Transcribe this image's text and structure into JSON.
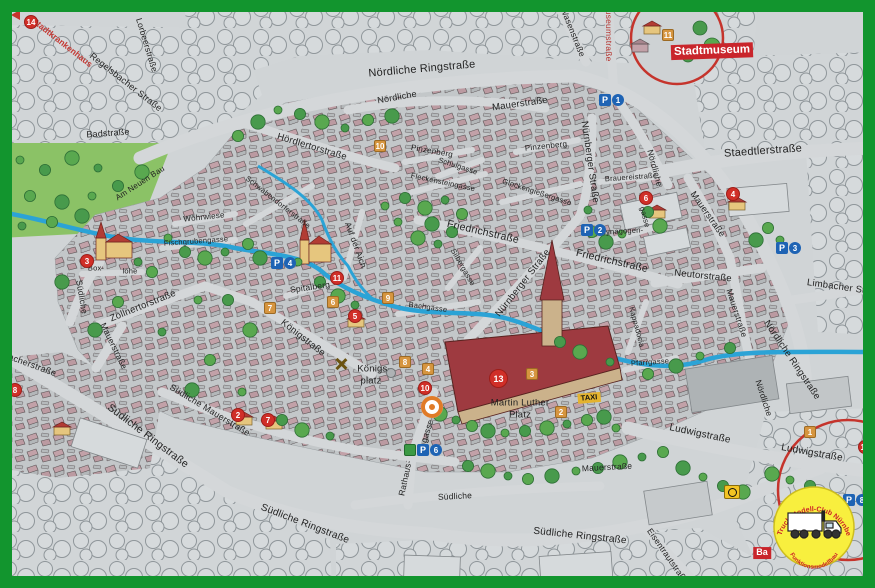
{
  "map": {
    "street_labels": [
      {
        "text": "Lorbeerstraße",
        "x": 147,
        "y": 45,
        "rot": 73,
        "size": 8.5
      },
      {
        "text": "Regelsbacher Straße",
        "x": 126,
        "y": 82,
        "rot": 38,
        "size": 9
      },
      {
        "text": "Badstraße",
        "x": 108,
        "y": 133,
        "rot": -4,
        "size": 9
      },
      {
        "text": "Am Neuen Bau",
        "x": 140,
        "y": 183,
        "rot": -33,
        "size": 8
      },
      {
        "text": "Wöhrwiese",
        "x": 204,
        "y": 217,
        "rot": -6,
        "size": 8
      },
      {
        "text": "Fischgrubengasse",
        "x": 196,
        "y": 241,
        "rot": -4,
        "size": 7.5
      },
      {
        "text": "Hördlertorstraße",
        "x": 312,
        "y": 147,
        "rot": 17,
        "size": 9.5
      },
      {
        "text": "Nördliche Ringstraße",
        "x": 422,
        "y": 69,
        "rot": -5,
        "size": 11
      },
      {
        "text": "Nördliche",
        "x": 397,
        "y": 97,
        "rot": -10,
        "size": 9
      },
      {
        "text": "Mauerstraße",
        "x": 520,
        "y": 104,
        "rot": -8,
        "size": 9.5
      },
      {
        "text": "Pinzenberg",
        "x": 432,
        "y": 151,
        "rot": 10,
        "size": 8
      },
      {
        "text": "Pinzenberg",
        "x": 546,
        "y": 146,
        "rot": -6,
        "size": 8
      },
      {
        "text": "Schulgasse",
        "x": 458,
        "y": 166,
        "rot": 18,
        "size": 7.5
      },
      {
        "text": "Fleckensteingasse",
        "x": 443,
        "y": 182,
        "rot": 12,
        "size": 7.5
      },
      {
        "text": "Glockengießergasse",
        "x": 537,
        "y": 192,
        "rot": 18,
        "size": 7.5
      },
      {
        "text": "Schwabendorferstraße",
        "x": 278,
        "y": 202,
        "rot": 38,
        "size": 7.5
      },
      {
        "text": "Auf der Aich",
        "x": 356,
        "y": 245,
        "rot": 70,
        "size": 8.5
      },
      {
        "text": "Wasenstraße",
        "x": 573,
        "y": 32,
        "rot": 68,
        "size": 8.5
      },
      {
        "text": "Museumstraße",
        "x": 609,
        "y": 32,
        "rot": 90,
        "size": 8.5,
        "color": "#b5342f"
      },
      {
        "text": "Staedtlerstraße",
        "x": 763,
        "y": 151,
        "rot": -4,
        "size": 11
      },
      {
        "text": "Nördliche",
        "x": 655,
        "y": 168,
        "rot": 75,
        "size": 8.5
      },
      {
        "text": "Brauereistraße",
        "x": 631,
        "y": 177,
        "rot": -4,
        "size": 7.5
      },
      {
        "text": "Mauerstraße",
        "x": 708,
        "y": 214,
        "rot": 55,
        "size": 9
      },
      {
        "text": "Nürnberger Straße",
        "x": 590,
        "y": 162,
        "rot": 82,
        "size": 9.5
      },
      {
        "text": "Friedrichstraße",
        "x": 483,
        "y": 232,
        "rot": 13,
        "size": 10.5
      },
      {
        "text": "Friedrichstraße",
        "x": 612,
        "y": 261,
        "rot": 13,
        "size": 10.5
      },
      {
        "text": "Nürnberger Straße",
        "x": 523,
        "y": 283,
        "rot": -52,
        "size": 9.5
      },
      {
        "text": "Silbergasse",
        "x": 463,
        "y": 267,
        "rot": 60,
        "size": 7.5
      },
      {
        "text": "Bachgasse",
        "x": 428,
        "y": 307,
        "rot": 8,
        "size": 7.5
      },
      {
        "text": "Synagogen-",
        "x": 622,
        "y": 231,
        "rot": -3,
        "size": 7.5
      },
      {
        "text": "gasse",
        "x": 645,
        "y": 217,
        "rot": 75,
        "size": 7.5
      },
      {
        "text": "Neutorstraße",
        "x": 703,
        "y": 276,
        "rot": 6,
        "size": 9.5
      },
      {
        "text": "Limbacher Straße",
        "x": 846,
        "y": 288,
        "rot": 8,
        "size": 9.5
      },
      {
        "text": "Kappadocia",
        "x": 637,
        "y": 327,
        "rot": 75,
        "size": 7.5
      },
      {
        "text": "Pfarrgasse",
        "x": 650,
        "y": 362,
        "rot": -4,
        "size": 7.5
      },
      {
        "text": "Mauerstraße",
        "x": 737,
        "y": 313,
        "rot": 72,
        "size": 8.5
      },
      {
        "text": "Nördliche Ringstraße",
        "x": 792,
        "y": 360,
        "rot": 56,
        "size": 9.5
      },
      {
        "text": "Zöllnertorstraße",
        "x": 143,
        "y": 306,
        "rot": -22,
        "size": 9.5
      },
      {
        "text": "Mauerstraße",
        "x": 114,
        "y": 346,
        "rot": 64,
        "size": 8.5
      },
      {
        "text": "Südliche",
        "x": 82,
        "y": 297,
        "rot": 80,
        "size": 8.5
      },
      {
        "text": "Königstraße",
        "x": 303,
        "y": 338,
        "rot": 38,
        "size": 9.5
      },
      {
        "text": "Spitalberg",
        "x": 310,
        "y": 287,
        "rot": -8,
        "size": 8.5
      },
      {
        "text": "Box-",
        "x": 96,
        "y": 268,
        "rot": 0,
        "size": 7.5
      },
      {
        "text": "lohe",
        "x": 130,
        "y": 271,
        "rot": 0,
        "size": 7.5
      },
      {
        "text": "Königs-",
        "x": 374,
        "y": 369,
        "rot": 0,
        "size": 9.5
      },
      {
        "text": "platz",
        "x": 371,
        "y": 381,
        "rot": 0,
        "size": 9.5
      },
      {
        "text": "Martin Luther",
        "x": 520,
        "y": 403,
        "rot": 0,
        "size": 9.5
      },
      {
        "text": "Platz",
        "x": 520,
        "y": 415,
        "rot": 0,
        "size": 9.5
      },
      {
        "text": "Südliche Mauerstraße",
        "x": 210,
        "y": 410,
        "rot": 31,
        "size": 9
      },
      {
        "text": "Südliche Ringstraße",
        "x": 148,
        "y": 436,
        "rot": 37,
        "size": 10.5
      },
      {
        "text": "Südliche Ringstraße",
        "x": 305,
        "y": 524,
        "rot": 21,
        "size": 10
      },
      {
        "text": "Südliche",
        "x": 455,
        "y": 496,
        "rot": -3,
        "size": 8.5
      },
      {
        "text": "Südliche Ringstraße",
        "x": 580,
        "y": 536,
        "rot": 6,
        "size": 10
      },
      {
        "text": "Rathaus-",
        "x": 405,
        "y": 478,
        "rot": -78,
        "size": 8.5
      },
      {
        "text": "gasse",
        "x": 427,
        "y": 431,
        "rot": -72,
        "size": 8.5
      },
      {
        "text": "Ludwigstraße",
        "x": 700,
        "y": 434,
        "rot": 12,
        "size": 10
      },
      {
        "text": "Ludwigstraße",
        "x": 812,
        "y": 453,
        "rot": 10,
        "size": 10
      },
      {
        "text": "Nördliche",
        "x": 764,
        "y": 398,
        "rot": 72,
        "size": 8.5
      },
      {
        "text": "Eisentrautstraße",
        "x": 668,
        "y": 556,
        "rot": 55,
        "size": 8.5
      },
      {
        "text": "Mauerstraße",
        "x": 607,
        "y": 467,
        "rot": -3,
        "size": 8.5
      },
      {
        "text": "bacherstraße",
        "x": 30,
        "y": 364,
        "rot": 20,
        "size": 9
      }
    ],
    "signs": [
      {
        "text": "Stadtkrankenhaus",
        "x": 62,
        "y": 43,
        "rot": 38,
        "size": 8.5,
        "color": "#c43a35",
        "bg": "transparent"
      },
      {
        "text": "Stadtmuseum",
        "x": 712,
        "y": 51,
        "rot": -2,
        "size": 11.5,
        "color": "#ffffff",
        "bg": "#c9252b"
      },
      {
        "text": "TAXI",
        "x": 589,
        "y": 398,
        "rot": -5,
        "size": 7.5,
        "color": "#111111",
        "bg": "#e4b32f"
      },
      {
        "text": "Ba",
        "x": 762,
        "y": 553,
        "rot": 0,
        "size": 9,
        "color": "#ffffff",
        "bg": "#c9252b"
      }
    ],
    "markers_red": [
      {
        "n": "14",
        "x": 31,
        "y": 22
      },
      {
        "n": "3",
        "x": 87,
        "y": 261
      },
      {
        "n": "11",
        "x": 337,
        "y": 278
      },
      {
        "n": "5",
        "x": 355,
        "y": 316
      },
      {
        "n": "10",
        "x": 425,
        "y": 388
      },
      {
        "n": "13",
        "x": 496,
        "y": 376,
        "big": true
      },
      {
        "n": "2",
        "x": 238,
        "y": 415
      },
      {
        "n": "7",
        "x": 268,
        "y": 420
      },
      {
        "n": "8",
        "x": 15,
        "y": 390
      },
      {
        "n": "6",
        "x": 646,
        "y": 198
      },
      {
        "n": "4",
        "x": 733,
        "y": 194
      },
      {
        "n": "12",
        "x": 865,
        "y": 447
      }
    ],
    "markers_orange": [
      {
        "n": "10",
        "x": 380,
        "y": 146
      },
      {
        "n": "11",
        "x": 668,
        "y": 35
      },
      {
        "n": "7",
        "x": 270,
        "y": 308
      },
      {
        "n": "6",
        "x": 333,
        "y": 302
      },
      {
        "n": "9",
        "x": 388,
        "y": 298
      },
      {
        "n": "8",
        "x": 405,
        "y": 362
      },
      {
        "n": "4",
        "x": 428,
        "y": 369
      },
      {
        "n": "3",
        "x": 532,
        "y": 374
      },
      {
        "n": "2",
        "x": 561,
        "y": 412
      },
      {
        "n": "1",
        "x": 810,
        "y": 432
      }
    ],
    "parking": [
      {
        "n": "1",
        "x": 611,
        "y": 100
      },
      {
        "n": "2",
        "x": 593,
        "y": 230
      },
      {
        "n": "3",
        "x": 788,
        "y": 248
      },
      {
        "n": "4",
        "x": 283,
        "y": 263
      },
      {
        "n": "5",
        "x": 3,
        "y": 295,
        "partial": true
      },
      {
        "n": "6",
        "x": 416,
        "y": 450,
        "green": true
      },
      {
        "n": "8",
        "x": 855,
        "y": 500
      }
    ],
    "poi_icons": [
      {
        "name": "location-ring",
        "x": 431,
        "y": 405
      },
      {
        "name": "posthorn",
        "x": 734,
        "y": 494
      },
      {
        "name": "crossed-hammers",
        "x": 344,
        "y": 366
      },
      {
        "name": "fountain",
        "x": 396,
        "y": 377
      },
      {
        "name": "direction-arrow",
        "x": 21,
        "y": 19
      }
    ],
    "logo": {
      "top": "1. Truck-Modell-Club Nürnberg",
      "bottom": "Funktionsmodellbau"
    },
    "colors": {
      "frame_green": "#12952e",
      "river_blue": "#2ba3d6",
      "marker_red": "#d02f28",
      "marker_orange": "#d6953f",
      "parking_blue": "#1e63b4",
      "sign_red": "#c9252b",
      "taxi_yellow": "#e4b32f",
      "logo_yellow": "#f8ef3e"
    }
  }
}
